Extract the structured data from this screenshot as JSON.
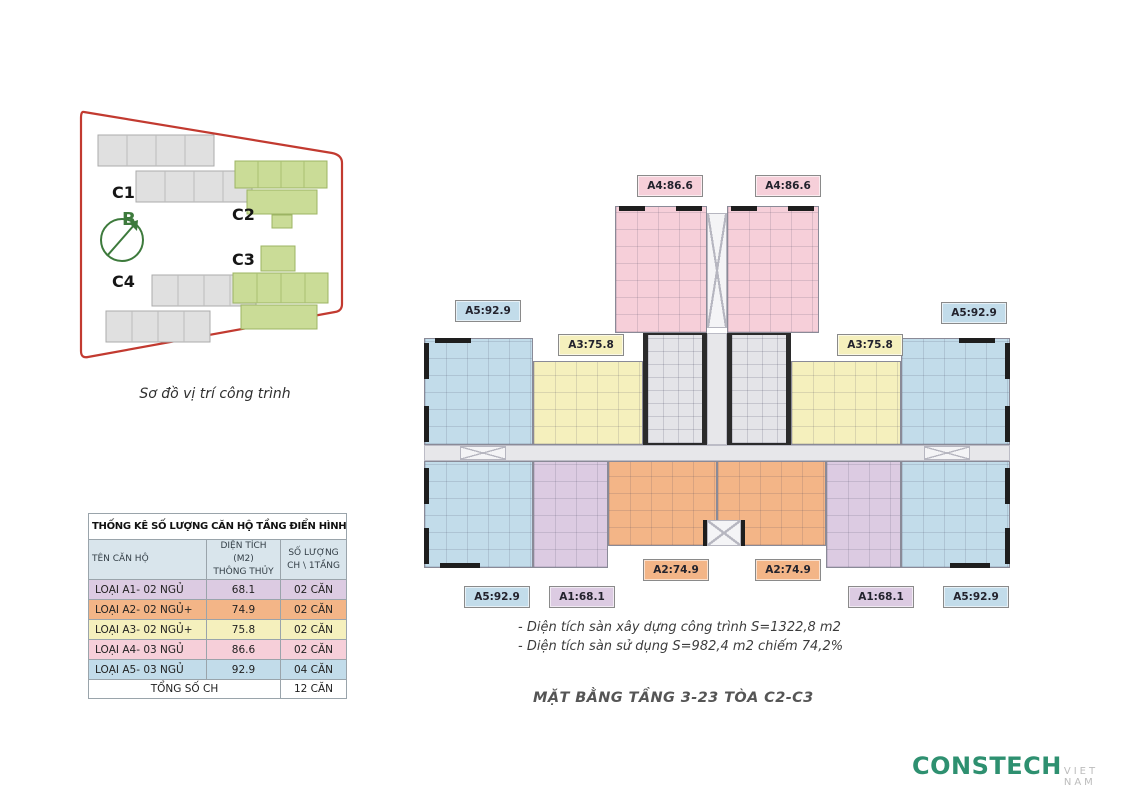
{
  "site_map": {
    "caption": "Sơ đồ vị trí công trình",
    "c1": "C1",
    "c2": "C2",
    "c3": "C3",
    "c4": "C4",
    "compass": "B"
  },
  "stats_table": {
    "title": "THỐNG KÊ SỐ LƯỢNG CĂN HỘ TẦNG ĐIỂN HÌNH C2-C3",
    "headers": [
      "TÊN CĂN HỘ",
      "DIỆN TÍCH (M2)\nTHÔNG THỦY",
      "SỐ LƯỢNG\nCH \\ 1TẦNG"
    ],
    "rows": [
      {
        "name": "LOẠI A1- 02 NGỦ",
        "area": "68.1",
        "count": "02 CĂN",
        "color_key": "a1"
      },
      {
        "name": "LOẠI A2- 02 NGỦ+",
        "area": "74.9",
        "count": "02 CĂN",
        "color_key": "a2"
      },
      {
        "name": "LOẠI A3- 02 NGỦ+",
        "area": "75.8",
        "count": "02 CĂN",
        "color_key": "a3"
      },
      {
        "name": "LOẠI A4- 03 NGỦ",
        "area": "86.6",
        "count": "02 CĂN",
        "color_key": "a4"
      },
      {
        "name": "LOẠI A5- 03 NGỦ",
        "area": "92.9",
        "count": "04 CĂN",
        "color_key": "a5"
      }
    ],
    "total_label": "TỔNG SỐ CH",
    "total_value": "12 CĂN"
  },
  "floor_plan": {
    "labels": [
      {
        "text": "A4:86.6",
        "color_key": "a4"
      },
      {
        "text": "A4:86.6",
        "color_key": "a4"
      },
      {
        "text": "A5:92.9",
        "color_key": "a5"
      },
      {
        "text": "A5:92.9",
        "color_key": "a5"
      },
      {
        "text": "A3:75.8",
        "color_key": "a3"
      },
      {
        "text": "A3:75.8",
        "color_key": "a3"
      },
      {
        "text": "A2:74.9",
        "color_key": "a2"
      },
      {
        "text": "A2:74.9",
        "color_key": "a2"
      },
      {
        "text": "A5:92.9",
        "color_key": "a5"
      },
      {
        "text": "A1:68.1",
        "color_key": "a1"
      },
      {
        "text": "A1:68.1",
        "color_key": "a1"
      },
      {
        "text": "A5:92.9",
        "color_key": "a5"
      }
    ],
    "notes": [
      "- Diện tích sàn xây dựng công trình S=1322,8 m2",
      "- Diện tích sàn sử dụng S=982,4 m2 chiếm 74,2%"
    ],
    "title": "MẶT BẰNG TẦNG 3-23 TÒA C2-C3"
  },
  "logo": {
    "name": "CONSTECH",
    "suffix": "VIET NAM"
  },
  "colors": {
    "a1": "#dccbe2",
    "a2": "#f3b587",
    "a3": "#f5f0bd",
    "a4": "#f6cfd9",
    "a5": "#c2dcea",
    "core_gray": "#e4e4e8",
    "header_bg": "#d9e5ec",
    "boundary_red": "#c23a30",
    "site_building_green": "#cadc97",
    "site_building_gray": "#e0e0e0",
    "compass_green": "#3d7a3c",
    "logo_green": "#2e9070"
  }
}
